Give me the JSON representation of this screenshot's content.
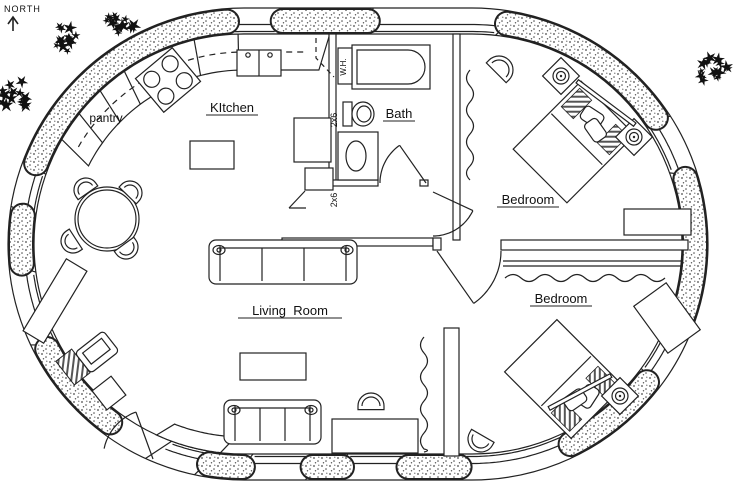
{
  "meta": {
    "width": 736,
    "height": 487,
    "title": "Oval earthbag house floor plan",
    "ink": "#222222",
    "paper": "#ffffff",
    "stipple_dot": "#4a4a4a"
  },
  "compass": {
    "label": "NORTH",
    "arrow_icon": "up-arrow"
  },
  "shell": {
    "x": 8,
    "y": 8,
    "w": 700,
    "h": 472,
    "corner": 236,
    "wall": 26
  },
  "stipple_segments": [
    [
      [
        282,
        21
      ],
      [
        368,
        22
      ]
    ],
    [
      [
        505,
        33
      ],
      [
        672,
        107
      ]
    ],
    [
      [
        707,
        172
      ],
      [
        701,
        332
      ]
    ],
    [
      [
        665,
        396
      ],
      [
        578,
        458
      ]
    ],
    [
      [
        460,
        469
      ],
      [
        408,
        469
      ]
    ],
    [
      [
        342,
        469
      ],
      [
        312,
        469
      ]
    ],
    [
      [
        243,
        469
      ],
      [
        208,
        467
      ]
    ],
    [
      [
        116,
        415
      ],
      [
        42,
        352
      ]
    ],
    [
      [
        24,
        264
      ],
      [
        20,
        215
      ]
    ],
    [
      [
        26,
        160
      ],
      [
        227,
        27
      ]
    ]
  ],
  "window_segments": [
    [
      [
        368,
        22
      ],
      [
        505,
        32
      ]
    ],
    [
      [
        672,
        107
      ],
      [
        706,
        168
      ]
    ],
    [
      [
        701,
        335
      ],
      [
        668,
        393
      ]
    ],
    [
      [
        575,
        462
      ],
      [
        462,
        469
      ]
    ],
    [
      [
        408,
        469
      ],
      [
        342,
        469
      ]
    ],
    [
      [
        312,
        469
      ],
      [
        243,
        469
      ]
    ],
    [
      [
        206,
        466
      ],
      [
        158,
        452
      ]
    ],
    [
      [
        40,
        348
      ],
      [
        24,
        268
      ]
    ],
    [
      [
        20,
        212
      ],
      [
        25,
        163
      ]
    ],
    [
      [
        230,
        25
      ],
      [
        280,
        22
      ]
    ]
  ],
  "interior_walls": [
    {
      "name": "kitchen-bath-wall",
      "r": [
        329,
        34,
        7,
        149
      ]
    },
    {
      "name": "bath-south-wall",
      "r": [
        332,
        180,
        46,
        6
      ]
    },
    {
      "name": "bath-door-stub",
      "r": [
        420,
        180,
        8,
        6
      ]
    },
    {
      "name": "bath-bedroom-wall",
      "r": [
        453,
        34,
        7,
        206
      ]
    },
    {
      "name": "hall-south-wall",
      "r": [
        282,
        238,
        151,
        8
      ]
    },
    {
      "name": "hall-cap",
      "r": [
        433,
        238,
        8,
        12
      ]
    },
    {
      "name": "bedroom-divider-wall",
      "r": [
        501,
        240,
        187,
        10
      ]
    },
    {
      "name": "living-bedroom-wall",
      "r": [
        444,
        328,
        15,
        128
      ]
    }
  ],
  "closet_double_lines": [
    {
      "x1": 503,
      "y": 261,
      "x2": 683,
      "gap": 5
    }
  ],
  "wavy_lines": [
    {
      "dir": "h",
      "x1": 505,
      "x2": 666,
      "y": 278
    },
    {
      "dir": "v",
      "x": 470,
      "y1": 70,
      "y2": 180
    },
    {
      "dir": "v",
      "x": 424,
      "y1": 337,
      "y2": 452
    }
  ],
  "counter": {
    "start": [
      78,
      148
    ],
    "end": [
      330,
      36
    ],
    "depth": 36,
    "dashed_upper_cabinets": true,
    "dividers": [
      [
        84,
        118
      ],
      [
        102,
        92
      ],
      [
        124,
        72
      ],
      [
        196,
        46
      ],
      [
        238,
        42
      ]
    ]
  },
  "bench": {
    "start": [
      218,
      468
    ],
    "end": [
      152,
      446
    ],
    "depth": 17
  },
  "doors": [
    {
      "name": "bath-door",
      "hx": 426,
      "hy": 183,
      "r": 46,
      "wallA": 180,
      "leafA": 125
    },
    {
      "name": "bedroom1-door",
      "hx": 433,
      "hy": 192,
      "r": 44,
      "wallA": -90,
      "leafA": -25
    },
    {
      "name": "bedroom2-door",
      "hx": 437,
      "hy": 251,
      "r": 64,
      "wallA": 0,
      "leafA": -55
    },
    {
      "name": "entry-door",
      "hx": 153,
      "hy": 459,
      "r": 50,
      "wallA": 168,
      "leafA": 110
    }
  ],
  "furniture": [
    {
      "name": "kitchen-island",
      "type": "rect",
      "x": 190,
      "y": 141,
      "w": 44,
      "h": 28
    },
    {
      "name": "kitchen-sink",
      "type": "sink",
      "x": 237,
      "y": 50,
      "w": 44,
      "h": 26
    },
    {
      "name": "stove",
      "type": "stove",
      "cx": 168,
      "cy": 80,
      "rot": -40
    },
    {
      "name": "refrigerator",
      "type": "rect",
      "x": 294,
      "y": 118,
      "w": 37,
      "h": 44
    },
    {
      "name": "kitchen-cabinet",
      "type": "rect",
      "x": 305,
      "y": 168,
      "w": 28,
      "h": 22
    },
    {
      "name": "cabinet-door-swing",
      "type": "line",
      "x1": 305,
      "y1": 191,
      "x2": 289,
      "y2": 208
    },
    {
      "name": "cabinet-door-swing",
      "type": "line",
      "x1": 289,
      "y1": 208,
      "x2": 306,
      "y2": 208
    },
    {
      "name": "upper-cabinet-dash",
      "type": "dash",
      "pts": [
        [
          316,
          38
        ],
        [
          316,
          58
        ],
        [
          334,
          77
        ]
      ]
    },
    {
      "name": "bathtub",
      "type": "tub",
      "x": 352,
      "y": 45,
      "w": 78,
      "h": 44
    },
    {
      "name": "water-heater",
      "type": "rect",
      "x": 338,
      "y": 48,
      "w": 14,
      "h": 36
    },
    {
      "name": "toilet",
      "type": "toilet",
      "cx": 360,
      "cy": 114
    },
    {
      "name": "bathroom-vanity",
      "type": "vanity",
      "x": 338,
      "y": 132,
      "w": 40,
      "h": 48
    },
    {
      "name": "bed",
      "type": "bed",
      "cx": 574,
      "cy": 142,
      "w": 76,
      "h": 96,
      "rot": 45
    },
    {
      "name": "nightstand-lamp",
      "type": "nightstand",
      "cx": 561,
      "cy": 76,
      "rot": 45
    },
    {
      "name": "nightstand-lamp",
      "type": "nightstand",
      "cx": 634,
      "cy": 137,
      "rot": 45
    },
    {
      "name": "bed-rail",
      "type": "rail",
      "cx": 606,
      "cy": 103,
      "w": 72,
      "h": 4,
      "rot": 37
    },
    {
      "name": "chair",
      "type": "chair",
      "cx": 499,
      "cy": 70,
      "r": 14,
      "rot": 45
    },
    {
      "name": "dresser",
      "type": "rect",
      "x": 624,
      "y": 209,
      "w": 67,
      "h": 26
    },
    {
      "name": "bed",
      "type": "bed",
      "cx": 564,
      "cy": 379,
      "w": 74,
      "h": 94,
      "rot": 135
    },
    {
      "name": "nightstand-lamp",
      "type": "nightstand",
      "cx": 620,
      "cy": 396,
      "rot": 45
    },
    {
      "name": "bed-rail",
      "type": "rail",
      "cx": 580,
      "cy": 392,
      "w": 70,
      "h": 4,
      "rot": -28
    },
    {
      "name": "dresser",
      "type": "rectR",
      "cx": 667,
      "cy": 318,
      "w": 40,
      "h": 58,
      "rot": -36
    },
    {
      "name": "chair",
      "type": "chair",
      "cx": 481,
      "cy": 439,
      "r": 13,
      "rot": 210
    },
    {
      "name": "sofa",
      "type": "sofa",
      "x": 209,
      "y": 240,
      "w": 148,
      "h": 44
    },
    {
      "name": "sofa",
      "type": "sofa",
      "x": 224,
      "y": 400,
      "w": 97,
      "h": 44
    },
    {
      "name": "coffee-table",
      "type": "rect",
      "x": 240,
      "y": 353,
      "w": 66,
      "h": 27
    },
    {
      "name": "desk",
      "type": "rect",
      "x": 332,
      "y": 419,
      "w": 86,
      "h": 34
    },
    {
      "name": "desk-chair",
      "type": "chair",
      "cx": 371,
      "cy": 406,
      "r": 13,
      "rot": 0
    },
    {
      "name": "dining-table",
      "type": "circle",
      "cx": 107,
      "cy": 219,
      "r": 32
    },
    {
      "name": "dining-chair",
      "type": "chair",
      "cx": 86,
      "cy": 190,
      "r": 12,
      "rot": -35
    },
    {
      "name": "dining-chair",
      "type": "chair",
      "cx": 130,
      "cy": 193,
      "r": 12,
      "rot": 44
    },
    {
      "name": "dining-chair",
      "type": "chair",
      "cx": 73,
      "cy": 241,
      "r": 12,
      "rot": 237
    },
    {
      "name": "dining-chair",
      "type": "chair",
      "cx": 126,
      "cy": 247,
      "r": 12,
      "rot": 144
    },
    {
      "name": "sideboard",
      "type": "rectR",
      "cx": 55,
      "cy": 301,
      "w": 24,
      "h": 84,
      "rot": 31
    },
    {
      "name": "computer-monitor",
      "type": "monitor",
      "cx": 97,
      "cy": 352,
      "rot": -38
    },
    {
      "name": "office-chair",
      "type": "rectR",
      "cx": 109,
      "cy": 393,
      "w": 24,
      "h": 24,
      "rot": -38
    },
    {
      "name": "desk-return",
      "type": "hatch",
      "cx": 73,
      "cy": 367,
      "w": 20,
      "h": 30,
      "rot": -38
    }
  ],
  "labels": [
    {
      "name": "room-label-kitchen",
      "text": "KItchen",
      "x": 232,
      "y": 112,
      "size": 13,
      "underline": true,
      "uw": 52
    },
    {
      "name": "room-label-pantry",
      "text": "pantry",
      "x": 106,
      "y": 122,
      "size": 12,
      "underline": false,
      "uw": 0
    },
    {
      "name": "room-label-bath",
      "text": "Bath",
      "x": 399,
      "y": 118,
      "size": 13,
      "underline": true,
      "uw": 32
    },
    {
      "name": "room-label-bedroom-1",
      "text": "Bedroom",
      "x": 528,
      "y": 204,
      "size": 13,
      "underline": true,
      "uw": 62
    },
    {
      "name": "room-label-bedroom-2",
      "text": "Bedroom",
      "x": 561,
      "y": 303,
      "size": 13,
      "underline": true,
      "uw": 62
    },
    {
      "name": "room-label-living-room",
      "text": "Living  Room",
      "x": 290,
      "y": 315,
      "size": 13,
      "underline": true,
      "uw": 104
    },
    {
      "name": "note-water-heater",
      "text": "W.H.",
      "x": 346,
      "y": 67,
      "size": 8,
      "rot": -90,
      "underline": false,
      "uw": 0
    },
    {
      "name": "note-2x6-wall",
      "text": "2x6",
      "x": 337,
      "y": 120,
      "size": 9,
      "rot": -90,
      "underline": false,
      "uw": 0
    },
    {
      "name": "note-2x6-wall",
      "text": "2x6",
      "x": 337,
      "y": 200,
      "size": 9,
      "rot": -90,
      "underline": false,
      "uw": 0
    }
  ],
  "trees": [
    {
      "cx": 117,
      "cy": 20,
      "r": 26,
      "seed": 7
    },
    {
      "cx": 68,
      "cy": 38,
      "r": 22,
      "seed": 11
    },
    {
      "cx": 14,
      "cy": 94,
      "r": 24,
      "seed": 23
    },
    {
      "cx": 716,
      "cy": 72,
      "r": 24,
      "seed": 5
    }
  ]
}
